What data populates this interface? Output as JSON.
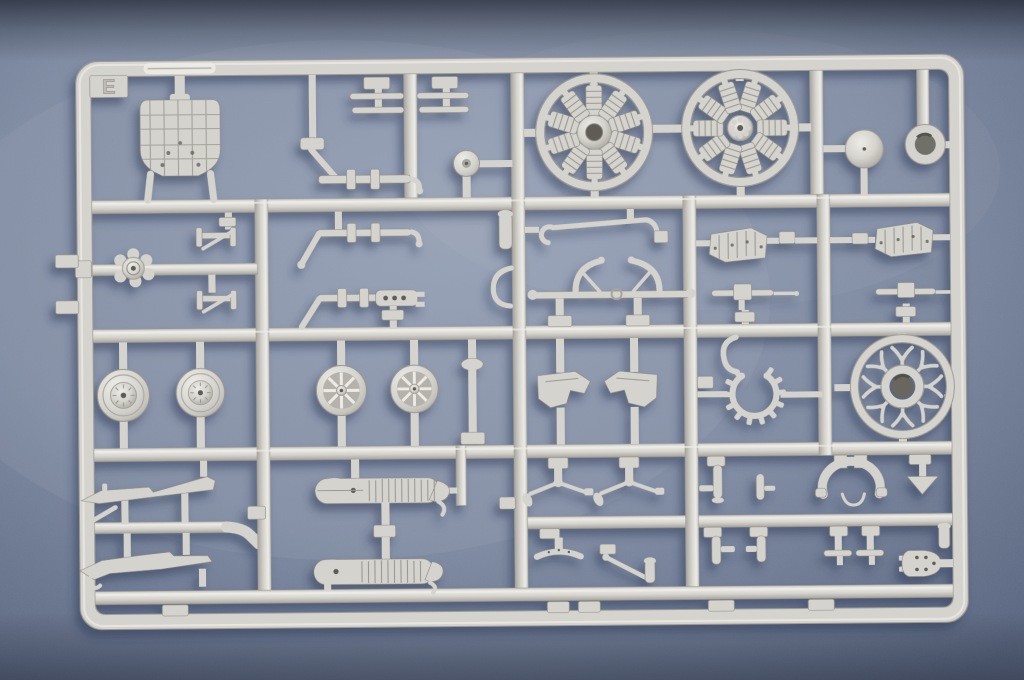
{
  "scene": {
    "type": "photograph",
    "subject": "Light gray injection-molded plastic model kit sprue (runner E) with aircraft parts, lying on a blue-gray fabric surface",
    "background_surface": "blue-gray mottled fabric"
  },
  "sprue": {
    "label": "E",
    "material_color_name": "light gray styrene",
    "grid_rows": 5,
    "grid_columns": 6
  },
  "colors": {
    "bg-center": "#939eb3",
    "bg-mid": "#7f8ba2",
    "bg-edge": "#57637d",
    "plastic": "#d5d3cd",
    "plastic-light": "#edebe5",
    "plastic-mid": "#c6c4be",
    "plastic-dark": "#a7a59d",
    "plastic-edge": "#8a887f",
    "hole": "#5e5c56",
    "shadow": "#2c3856"
  },
  "parts": {
    "letter_tab": "Runner letter tab E",
    "marking_strip": "Embossed runner marking (illegible)",
    "bulkhead": "Cockpit bulkhead plate with panel lines",
    "push_rods_left": "Pair of push rods",
    "push_rods_right": "Pair of push rods",
    "control_shaft": "Control shaft with bellcrank arm and collars",
    "tail_wheel": "Tail wheel",
    "engine_row_a": "Radial engine cylinder row (open hub)",
    "engine_row_b": "Radial engine cylinder row (rocker hub)",
    "firewall_disc": "Firewall disc",
    "cowling_ring": "Cowling ring",
    "carburetor": "Carburetor / pump cluster",
    "jack_upper": "Strut jack brace (upper)",
    "jack_lower": "Strut jack brace (lower)",
    "axle_rod": "Axle rod with collars and crank arm",
    "bellcrank_rod": "Control rod with drilled bellcrank plate",
    "cylinder_fitting": "Small cylinder fitting",
    "curved_arm": "Curved arm",
    "hooked_pipe": "Pipe with hooked end",
    "engine_mount": "Arched engine mount frame",
    "exhaust_panel_left": "Ribbed exhaust shroud panel (left)",
    "exhaust_panel_right": "Ribbed exhaust shroud panel (right)",
    "machine_gun_left": "Machine gun (left)",
    "machine_gun_right": "Machine gun (right)",
    "wheel_covered_outer": "Main wheel, covered hub (outer)",
    "wheel_covered_inner": "Main wheel, covered hub (inner)",
    "wheel_spoked_outer": "Main wheel, spoked (outer)",
    "wheel_spoked_inner": "Main wheel, spoked (inner)",
    "wheel_fork": "Wheel fork with fender cap",
    "cowl_panel_left": "Cowl side panel (left)",
    "cowl_panel_right": "Cowl side panel (right)",
    "curved_pipe": "Curved intake pipe",
    "exhaust_ring": "Exhaust collector ring with stubs",
    "crankcase_ring": "Crankcase ring with push-rod spider",
    "strut_blade_upper": "Strut fairing blade (upper)",
    "strut_blade_lower": "Strut fairing blade (lower)",
    "angled_rod": "Short angled rod",
    "float_upper": "Corrugated control surface (upper)",
    "float_lower": "Corrugated control surface (lower)",
    "rocker_left": "Rocker arm with counterweight (left)",
    "rocker_right": "Rocker arm with counterweight (right)",
    "seat_brace": "Curved seat brace",
    "lever": "Angled lever",
    "small_cylinder": "Small cylinder",
    "bracket_fittings": "Bracket fittings",
    "t_fittings": "T-shaped fittings",
    "instrument_hoop": "Instrument panel hoop with wire hook",
    "tail_skid": "Tail skid (arrow shaped)",
    "inspection_plate": "Inspection plate with lightening holes",
    "runner_stubs": "Runner feed stubs",
    "gate_pads": "Molding gate pads"
  }
}
